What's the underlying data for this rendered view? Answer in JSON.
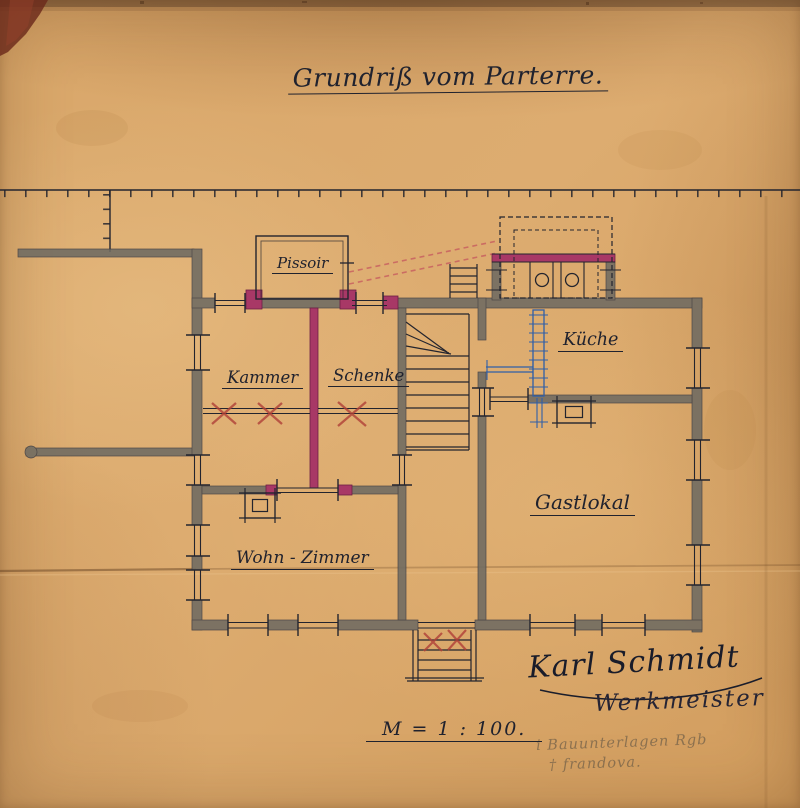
{
  "document": {
    "title": "Grundriß vom Parterre.",
    "scale_label": "M = 1 : 100.",
    "signature_name": "Karl Schmidt",
    "signature_title": "Werkmeister",
    "pencil_note_line1": "i Bauunterlagen Rgb",
    "pencil_note_line2": "† frandova."
  },
  "rooms": {
    "pissoir": "Pissoir",
    "kammer": "Kammer",
    "schenke": "Schenke",
    "kueche": "Küche",
    "gastlokal": "Gastlokal",
    "wohnzimmer": "Wohn - Zimmer"
  },
  "colors": {
    "paper": "#d9a566",
    "ink": "#23242e",
    "wall": "#6f6b62",
    "crimson": "#a83866",
    "red_mark": "#b04038",
    "blue": "#2f5fa8",
    "pencil": "#756249"
  }
}
